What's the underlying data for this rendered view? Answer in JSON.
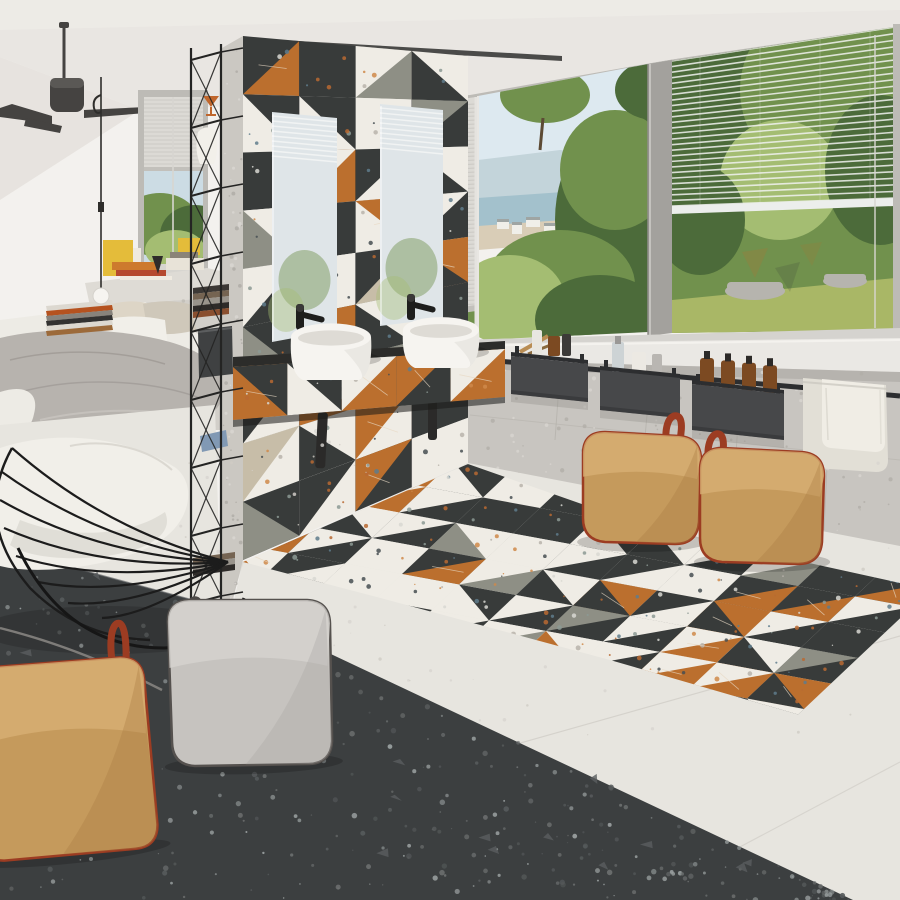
{
  "scene": {
    "description": "Photorealistic interior render: open-plan bedroom-bathroom with a freestanding partition wall clad in patchwork terrazzo tiles, twin white vessel basins on a tiled floating vanity, large windows with venetian blinds and coastal/garden views, a bed, a black wire lounge chair, leather poufs with loop handles, wall rail with storage boxes and toiletries, and a terrazzo tile floor with a patterned tile 'rug' strip.",
    "text_visible": "none"
  },
  "palette": {
    "ceiling": "#e9e6e2",
    "wall": "#f3f1ee",
    "wallShade": "#e3e0db",
    "slot": "#3a3a38",
    "frame": "#bdbbb6",
    "frameDark": "#a3a19d",
    "blind": "#dcdad5",
    "blindLine": "#c9c7c2",
    "skyLeft": "#ccdce4",
    "sky": "#dde9f0",
    "sea": "#a3c1cc",
    "sand": "#d9cdb7",
    "building": "#f0efe9",
    "greenDark": "#4c6b3a",
    "greenMid": "#71914d",
    "greenLight": "#a4bd72",
    "lawn": "#a9b766",
    "planter": "#b6b4ae",
    "tileDark": "#383b3a",
    "tileWhite": "#efece5",
    "tileOrange": "#bb6f2e",
    "tileGray": "#8e8f85",
    "tileBeige": "#c7bda8",
    "concrete": "#cbc8c2",
    "mirror": "#dfe5e8",
    "counterDark": "#2c2c2a",
    "basin": "#f6f4f0",
    "basinShade": "#dedbd5",
    "black": "#1e1e1d",
    "kneeWall": "#c8c5c0",
    "sill": "#eae8e4",
    "railBox": "#47484a",
    "boxDark": "#2d2e30",
    "towel": "#f0ede5",
    "towel2": "#e2dfd6",
    "floorWhite": "#e7e5df",
    "floorDark": "#3c3f40",
    "poufTan": "#c59a5c",
    "poufTanLight": "#d8b075",
    "poufTanShade": "#a87c42",
    "piping": "#9c3c22",
    "poufGray": "#c6c3bf",
    "poufGrayShade": "#a9a6a2",
    "loopGray": "#4b4846",
    "blanket": "#b7b3ae",
    "blanketFold": "#9d9994",
    "sheet": "#edebe5",
    "pillow": "#ddd5c6",
    "bookYellow": "#e4bc3a",
    "bookOrange": "#cd7a2d",
    "bookRed": "#b5492f",
    "wood": "#b98d54",
    "amber": "#7c4a22",
    "glassBottle": "#cdd3d5",
    "shelfBlack": "#242423",
    "fan": "#454341",
    "cord": "#2e2d2b",
    "bulb": "#f6f4f0",
    "speckOnDark": [
      "#d8d8d2",
      "#b86a32",
      "#5f7d8c",
      "#8c9a94"
    ],
    "speckOnWhite": [
      "#b9b4ab",
      "#cf8a4a",
      "#474f52"
    ],
    "speckFloorDark": [
      "#6b6e6e",
      "#9aa0a0",
      "#565a5b"
    ],
    "speckFloorWhite": [
      "#d8d5cf",
      "#cfccc4"
    ],
    "speckConcrete": [
      "#b1aea8",
      "#d8d5d0"
    ]
  },
  "partition_wall": {
    "cols": 4,
    "rows": 9,
    "tiles": [
      [
        "D/O:br",
        "D",
        "G/W:tl",
        "D/W:tr"
      ],
      [
        "W/D:tr",
        "D/W:bl",
        "W",
        "D/G:tl"
      ],
      [
        "D",
        "O/W:tl",
        "D/W:br",
        "W/D:bl"
      ],
      [
        "W/G:bl",
        "D",
        "W/O:tr",
        "D/W:tl"
      ],
      [
        "D/W:tl",
        "W",
        "D/B:br",
        "O/D:bl"
      ],
      [
        "G/D:tr",
        "D/O:tr",
        "W/D:bl",
        "D"
      ],
      [
        "D/W:br",
        "W/O:bl",
        "D/G:tl",
        "W/D:tr"
      ],
      [
        "W/B:tl",
        "D/W:tr",
        "O/W:br",
        "D"
      ],
      [
        "D/G:bl",
        "W/D:tl",
        "D/O:tl",
        "W"
      ]
    ]
  },
  "counter_tiles": [
    "O/D:tr",
    "D/W:bl",
    "W/O:br",
    "D/O:tl",
    "O/W:tl"
  ],
  "rug": {
    "seed": 11,
    "cols": 14,
    "rows": 8,
    "pool": [
      "D",
      "W",
      "D/W:tl",
      "D/W:br",
      "W/D:tr",
      "W/D:bl",
      "O/W:tl",
      "D/O:br",
      "G/W:tr",
      "W/O:bl",
      "D/G:tl",
      "W/G:br",
      "D/W:tr",
      "W/D:br",
      "O/D:bl",
      "W"
    ]
  },
  "fixtures": {
    "basins": 2,
    "faucets": 2,
    "mirrors": 2,
    "storage_boxes": 3,
    "bottles": {
      "box1": [
        "white bottle",
        "amber jar",
        "dark jar",
        "wooden brushes"
      ],
      "box2": [
        "pump bottle",
        "white jar",
        "gray tube"
      ],
      "box3_amber_count": 4
    },
    "towels": 1
  },
  "furniture": {
    "bed": {
      "bedding": [
        "white sheet",
        "gray blanket",
        "two pillows"
      ]
    },
    "wire_chair": {
      "color": "black",
      "cushion": "white"
    },
    "poufs": [
      {
        "id": "tan-right-front",
        "color": "tan",
        "handle": "red loop"
      },
      {
        "id": "tan-right-back",
        "color": "tan",
        "handle": "red loop"
      },
      {
        "id": "gray-center",
        "color": "gray",
        "handle": "dark loop"
      },
      {
        "id": "tan-bottom-left",
        "color": "tan",
        "handle": "red loop"
      }
    ],
    "shelving_unit": {
      "color": "black",
      "items": [
        "books",
        "white vase",
        "orange goblet",
        "planter box",
        "blue folder"
      ]
    },
    "ceiling_fan": 1,
    "pendant_lamp": 1,
    "ledge_books": [
      "yellow",
      "orange",
      "red",
      "white"
    ]
  }
}
